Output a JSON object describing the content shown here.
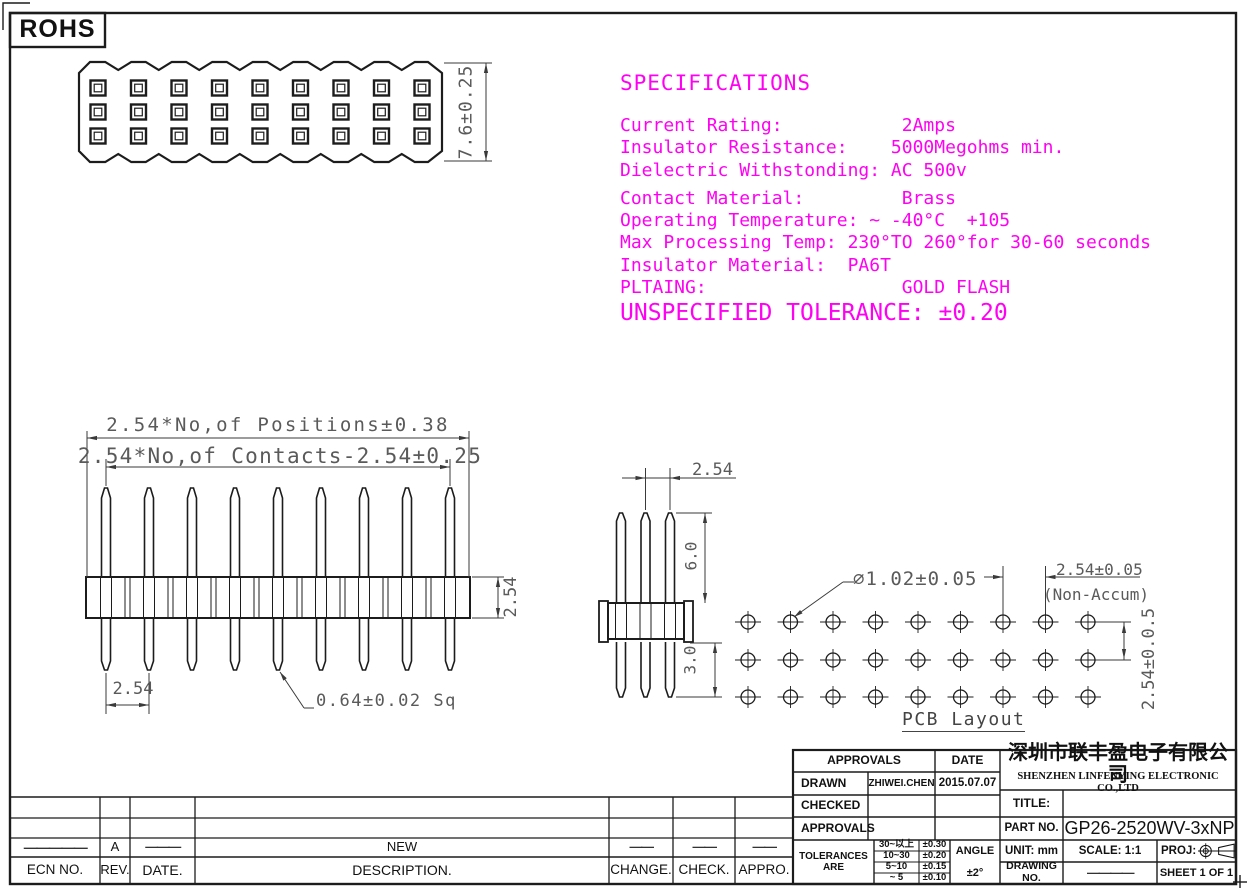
{
  "rohs": "ROHS",
  "specifications": {
    "title": "SPECIFICATIONS",
    "lines": [
      "Current Rating:           2Amps",
      "Insulator Resistance:    5000Megohms min.",
      "Dielectric Withstonding: AC 500v",
      "Contact Material:         Brass",
      "Operating Temperature: ~ -40°C  +105",
      "Max Processing Temp: 230°TO 260°for 30-60 seconds",
      "Insulator Material:  PA6T",
      "PLTAING:                  GOLD FLASH"
    ],
    "note": "UNSPECIFIED TOLERANCE: ±0.20"
  },
  "dimensions": {
    "top_view_height": "7.6±0.25",
    "positions": "2.54*No,of Positions±0.38",
    "contacts": "2.54*No,of Contacts-2.54±0.25",
    "row_pitch": "2.54",
    "pin_pitch": "2.54",
    "pin_square": "0.64±0.02 Sq",
    "front_pitch": "2.54",
    "pin_length_above": "6.0",
    "pin_length_below": "3.0",
    "hole_diameter": "∅1.02±0.05",
    "hole_pitch_h": "2.54±0.05",
    "hole_pitch_h_note": "(Non-Accum)",
    "hole_pitch_v": "2.54±0.0.5",
    "pcb_caption": "PCB Layout"
  },
  "title_block": {
    "approvals_header": "APPROVALS",
    "date_header": "DATE",
    "drawn_label": "DRAWN",
    "drawn_name": "ZHIWEI.CHEN",
    "drawn_date": "2015.07.07",
    "checked_label": "CHECKED",
    "approvals_label": "APPROVALS",
    "tolerances_label": "TOLERANCES ARE",
    "tolerance_rows": [
      {
        "range": "30~以上",
        "value": "±0.30"
      },
      {
        "range": "10~30",
        "value": "±0.20"
      },
      {
        "range": "5~10",
        "value": "±0.15"
      },
      {
        "range": "~ 5",
        "value": "±0.10"
      }
    ],
    "angle_label": "ANGLE",
    "angle_value": "±2°",
    "company_cn": "深圳市联丰盈电子有限公司",
    "company_en": "SHENZHEN LINFENYING ELECTRONIC CO.,LTD",
    "title_label": "TITLE:",
    "part_no_label": "PART  NO.",
    "part_no_value": "GP26-2520WV-3xNP",
    "unit_label": "UNIT:  mm",
    "scale_label": "SCALE:   1:1",
    "proj_label": "PROJ:",
    "drawing_no_label": "DRAWING  NO.",
    "drawing_no_dash": "————",
    "sheet_label": "SHEET  1  OF  1"
  },
  "revision_table": {
    "headers": [
      "ECN  NO.",
      "REV.",
      "DATE.",
      "DESCRIPTION.",
      "CHANGE.",
      "CHECK.",
      "APPRO."
    ],
    "row_a": {
      "ecn": "—————",
      "rev": "A",
      "date": "———",
      "description": "NEW",
      "change": "——",
      "check": "——",
      "appro": "——"
    }
  }
}
